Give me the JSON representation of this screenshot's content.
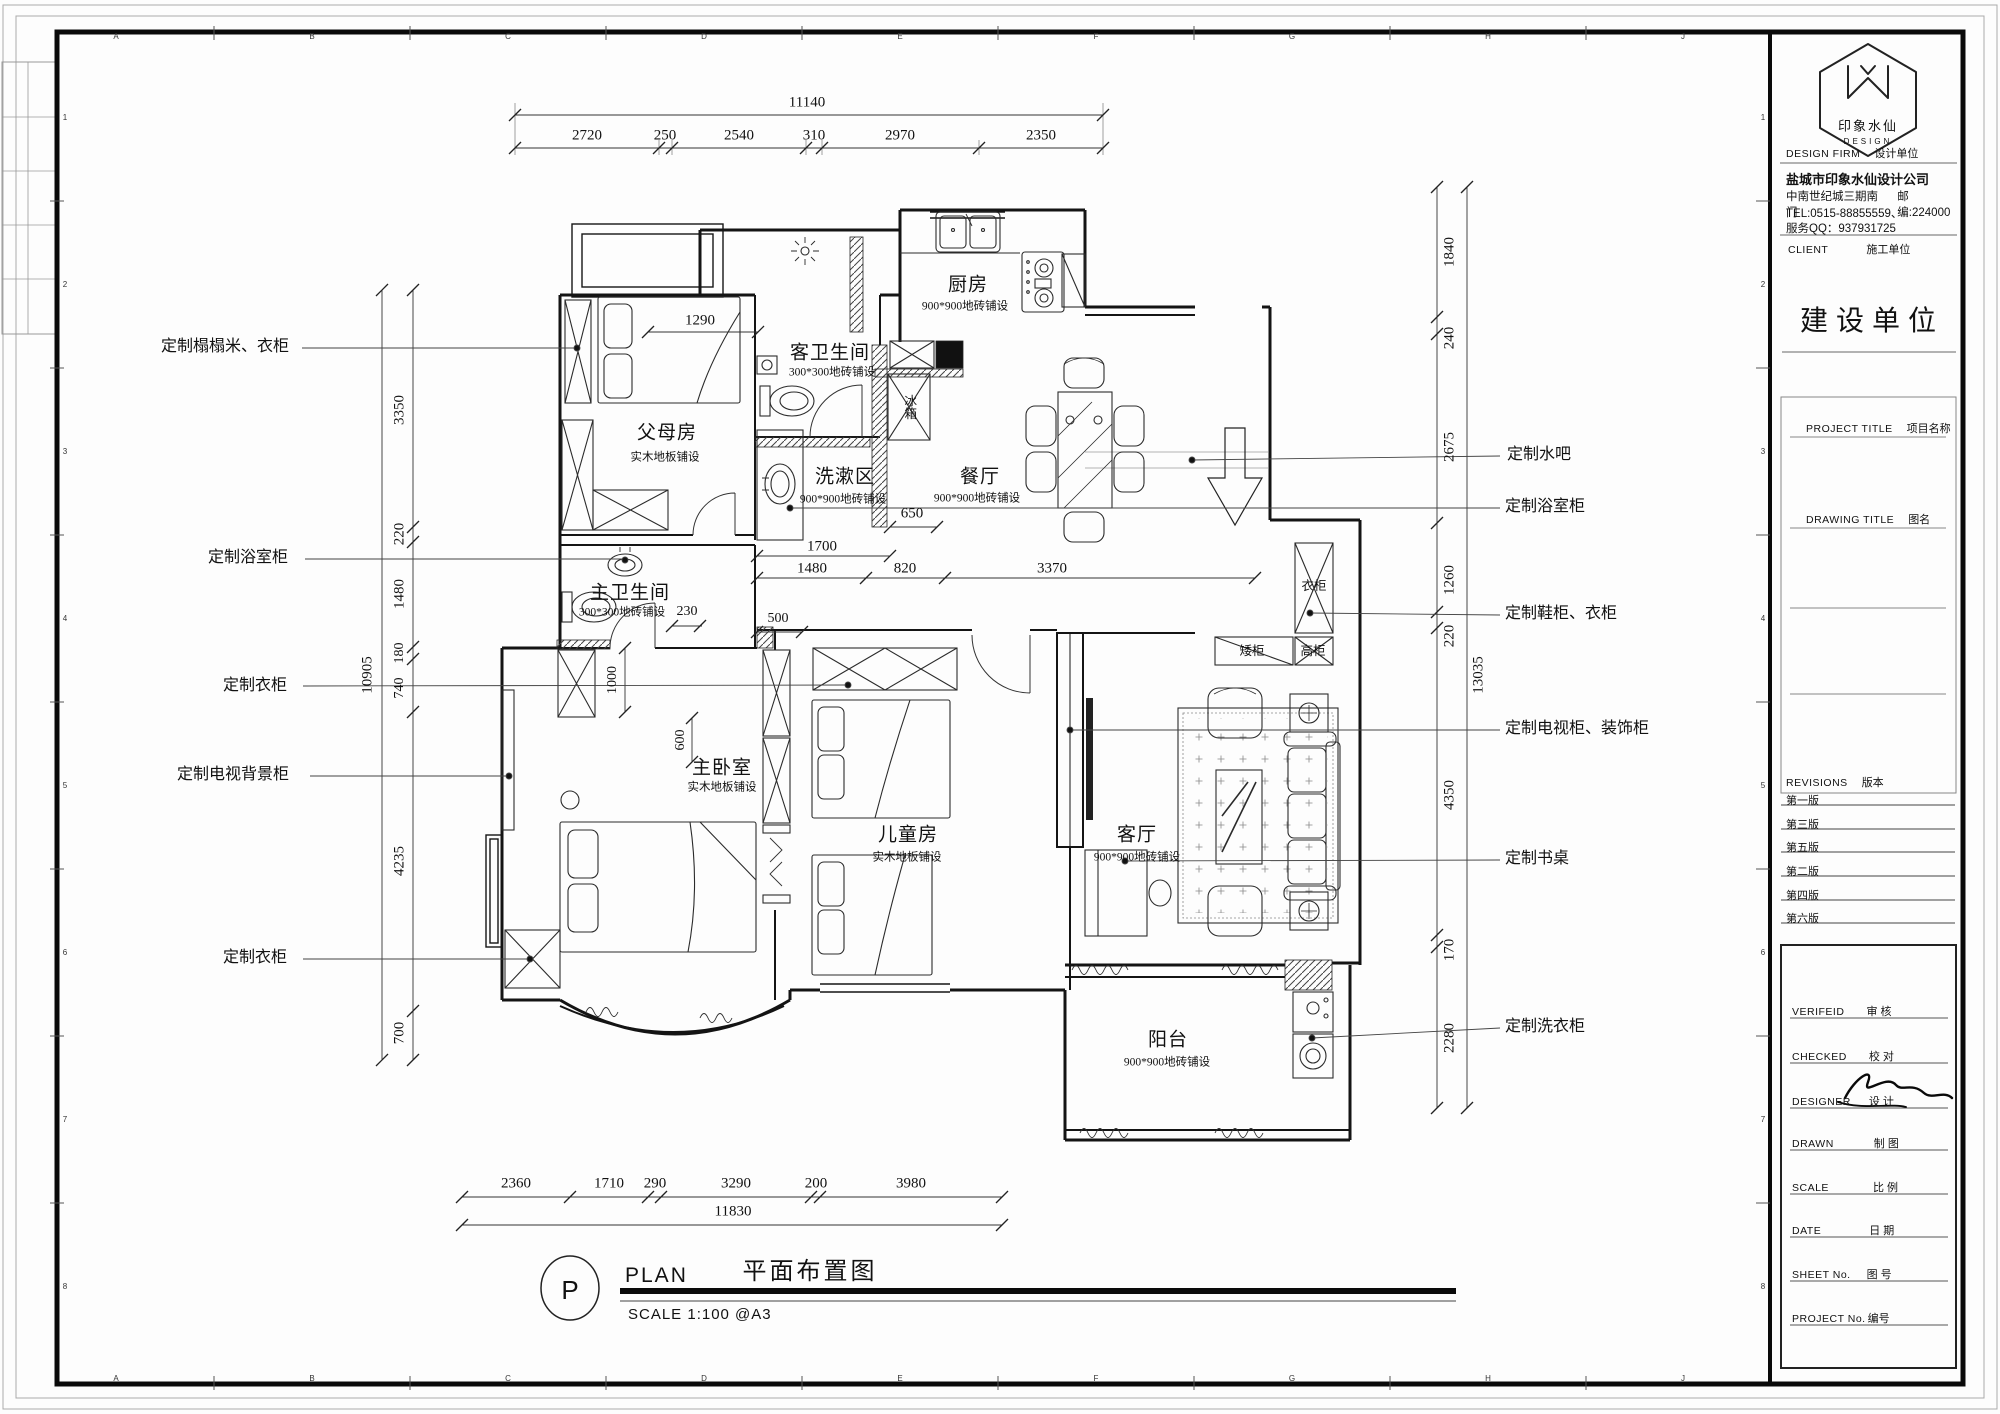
{
  "sheet": {
    "grid_letters": [
      "A",
      "B",
      "C",
      "D",
      "E",
      "F",
      "G",
      "H",
      "J"
    ],
    "grid_numbers": [
      "1",
      "2",
      "3",
      "4",
      "5",
      "6",
      "7",
      "8"
    ]
  },
  "title_block": {
    "logo": {
      "name": "印象水仙",
      "sub": "DESIGN"
    },
    "design_firm_en": "DESIGN FIRM",
    "design_firm_cn": "设计单位",
    "company": "盐城市印象水仙设计公司",
    "address": "中南世纪城三期南门",
    "postcode": "邮编:224000",
    "tel": "TEL:0515-88855559、",
    "qq": "服务QQ：937931725",
    "client_en": "CLIENT",
    "client_cn": "施工单位",
    "owner_title": "建设单位",
    "project_title_en": "PROJECT TITLE",
    "project_title_cn": "项目名称",
    "drawing_title_en": "DRAWING TITLE",
    "drawing_title_cn": "图名",
    "revisions_en": "REVISIONS",
    "revisions_cn": "版本",
    "revisions": [
      "第一版",
      "第三版",
      "第五版",
      "第二版",
      "第四版",
      "第六版"
    ],
    "verified_en": "VERIFEID",
    "verified_cn": "审  核",
    "checked_en": "CHECKED",
    "checked_cn": "校  对",
    "designer_en": "DESIGNER",
    "designer_cn": "设  计",
    "drawn_en": "DRAWN",
    "drawn_cn": "制  图",
    "scale_en": "SCALE",
    "scale_cn": "比  例",
    "date_en": "DATE",
    "date_cn": "日  期",
    "sheet_no_en": "SHEET No.",
    "sheet_no_cn": "图  号",
    "project_no_en": "PROJECT No.",
    "project_no_cn": "编号"
  },
  "plan": {
    "rooms": [
      {
        "name": "父母房",
        "floor": "实木地板铺设"
      },
      {
        "name": "客卫生间",
        "floor": "300*300地砖铺设"
      },
      {
        "name": "厨房",
        "floor": "900*900地砖铺设"
      },
      {
        "name": "餐厅",
        "floor": "900*900地砖铺设"
      },
      {
        "name": "洗漱区",
        "floor": "900*900地砖铺设"
      },
      {
        "name": "主卫生间",
        "floor": "300*300地砖铺设"
      },
      {
        "name": "主卧室",
        "floor": "实木地板铺设"
      },
      {
        "name": "儿童房",
        "floor": "实木地板铺设"
      },
      {
        "name": "客厅",
        "floor": "900*900地砖铺设"
      },
      {
        "name": "阳台",
        "floor": "900*900地砖铺设"
      }
    ],
    "fixtures": {
      "wardrobe": "衣柜",
      "low_cabinet": "矮柜",
      "tall_cabinet": "高柜",
      "fridge": "冰箱"
    },
    "callouts_left": [
      "定制榻榻米、衣柜",
      "定制浴室柜",
      "定制衣柜",
      "定制电视背景柜",
      "定制衣柜"
    ],
    "callouts_right": [
      "定制水吧",
      "定制浴室柜",
      "定制鞋柜、衣柜",
      "定制电视柜、装饰柜",
      "定制书桌",
      "定制洗衣柜"
    ]
  },
  "dimensions": {
    "top": {
      "overall": "11140",
      "segments": [
        "2720",
        "250",
        "2540",
        "310",
        "2970",
        "2350"
      ]
    },
    "bottom": {
      "overall": "11830",
      "segments": [
        "2360",
        "1710",
        "290",
        "3290",
        "200",
        "3980"
      ]
    },
    "left": {
      "overall": "10905",
      "segments": [
        "3350",
        "220",
        "1480",
        "180",
        "740",
        "4235",
        "700"
      ]
    },
    "right": {
      "overall": "13035",
      "segments": [
        "1840",
        "240",
        "2675",
        "1260",
        "220",
        "4350",
        "170",
        "2280"
      ]
    },
    "interior": {
      "entry": "1290",
      "niche": "650",
      "wash_total": "1700",
      "wash_a": "1480",
      "wash_b": "820",
      "hall": "3370",
      "mb_a": "230",
      "mb_b": "500",
      "mb_c": "1000",
      "mb_d": "600"
    }
  },
  "title_bar": {
    "bubble": "P",
    "label": "PLAN",
    "title_cn": "平面布置图",
    "scale": "SCALE  1:100   @A3"
  }
}
